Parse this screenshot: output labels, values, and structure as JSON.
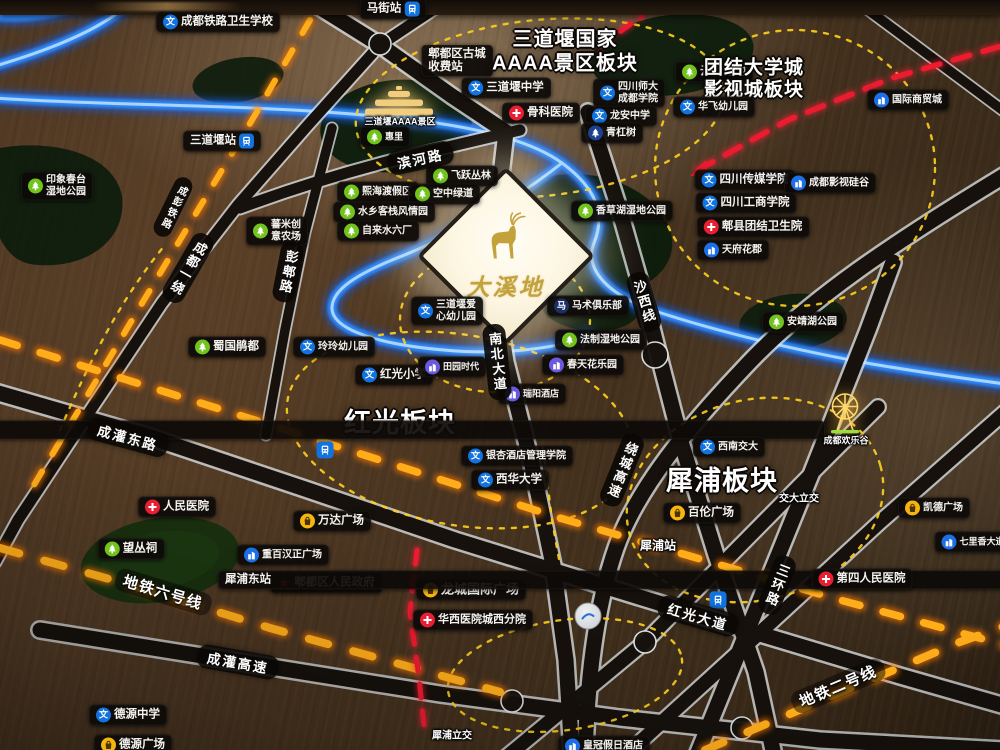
{
  "scene": {
    "description": "Illuminated sales-office district map model, Pidu District Chengdu",
    "project_sign": "大溪地"
  },
  "map": {
    "sign": {
      "text": "大溪地",
      "logo": "deer"
    },
    "palette": {
      "wood": "#47331f",
      "road_dark": "#15100c",
      "road_edge": "#e9edf0",
      "river_glow": "#2f8dff",
      "rail_amber": "#ff9d0e",
      "boundary_yellow": "#ffd21c",
      "route_red": "#ed1b2f",
      "pill_bg": "#0d0a07",
      "icon_school": "#1273e0",
      "icon_hospital": "#e81f33",
      "icon_park": "#72c41d",
      "icon_estate": "#1d6fe8",
      "icon_estate_purple": "#6a5ae0",
      "icon_shop": "#f6b40e",
      "icon_navy": "#1b2f66",
      "sign_gold": "#c3a13b"
    },
    "labels": [
      {
        "t": "成都铁路卫生学校",
        "x": 218,
        "y": 22,
        "k": "pill",
        "ic": "school"
      },
      {
        "t": "马街站",
        "x": 393,
        "y": 9,
        "k": "station"
      },
      {
        "lines": [
          "郫都区古城",
          "收费站"
        ],
        "x": 457,
        "y": 61,
        "k": "pill"
      },
      {
        "lines": [
          "三道堰国家",
          "AAAA景区板块"
        ],
        "x": 565,
        "y": 52,
        "k": "plate",
        "s": 20
      },
      {
        "t": "云桥湿地",
        "x": 714,
        "y": 72,
        "k": "pill",
        "ic": "park"
      },
      {
        "lines": [
          "团结大学城",
          "影视城板块"
        ],
        "x": 754,
        "y": 80,
        "k": "plate",
        "s": 19
      },
      {
        "t": "国际商贸城",
        "x": 908,
        "y": 100,
        "k": "pill",
        "ic": "estate",
        "s": 10
      },
      {
        "t": "三道堰中学",
        "x": 506,
        "y": 88,
        "k": "pill",
        "ic": "school"
      },
      {
        "lines": [
          "四川师大",
          "成都学院"
        ],
        "x": 629,
        "y": 93,
        "k": "pill",
        "ic": "school",
        "s": 10
      },
      {
        "t": "龙安中学",
        "x": 621,
        "y": 116,
        "k": "pill",
        "ic": "school",
        "s": 10
      },
      {
        "t": "骨科医院",
        "x": 541,
        "y": 113,
        "k": "pill",
        "ic": "hosp"
      },
      {
        "t": "华飞幼儿园",
        "x": 714,
        "y": 107,
        "k": "pill",
        "ic": "school",
        "s": 10
      },
      {
        "t": "三道堰站",
        "x": 222,
        "y": 141,
        "k": "station"
      },
      {
        "t": "青杠树",
        "x": 612,
        "y": 133,
        "k": "pill",
        "ic": "treeb",
        "s": 10
      },
      {
        "t": "三道堰AAAA景区",
        "x": 400,
        "y": 121,
        "k": "roadtext",
        "s": 9
      },
      {
        "t": "惠里",
        "x": 385,
        "y": 137,
        "k": "pill",
        "ic": "park",
        "s": 9
      },
      {
        "lines": [
          "印象春台",
          "湿地公园"
        ],
        "x": 57,
        "y": 186,
        "k": "pill",
        "ic": "park",
        "s": 10
      },
      {
        "t": "熙海渡假区",
        "x": 378,
        "y": 192,
        "k": "pill",
        "ic": "park",
        "s": 10
      },
      {
        "t": "飞跃丛林",
        "x": 462,
        "y": 176,
        "k": "pill",
        "ic": "park",
        "s": 10
      },
      {
        "t": "空中绿道",
        "x": 444,
        "y": 194,
        "k": "pill",
        "ic": "park",
        "s": 10
      },
      {
        "t": "水乡客栈风情园",
        "x": 384,
        "y": 212,
        "k": "pill",
        "ic": "park",
        "s": 10
      },
      {
        "t": "自来水六厂",
        "x": 378,
        "y": 231,
        "k": "pill",
        "ic": "park",
        "s": 10
      },
      {
        "lines": [
          "蕃米创",
          "意农场"
        ],
        "x": 277,
        "y": 231,
        "k": "pill",
        "ic": "park",
        "s": 10
      },
      {
        "t": "香草湖湿地公园",
        "x": 622,
        "y": 211,
        "k": "pill",
        "ic": "park",
        "s": 10
      },
      {
        "t": "四川传媒学院",
        "x": 745,
        "y": 180,
        "k": "pill",
        "ic": "school"
      },
      {
        "t": "成都影视硅谷",
        "x": 830,
        "y": 183,
        "k": "pill",
        "ic": "estate",
        "s": 10
      },
      {
        "t": "四川工商学院",
        "x": 746,
        "y": 203,
        "k": "pill",
        "ic": "school"
      },
      {
        "t": "郫县团结卫生院",
        "x": 753,
        "y": 227,
        "k": "pill",
        "ic": "hosp"
      },
      {
        "t": "天府花郡",
        "x": 733,
        "y": 250,
        "k": "pill",
        "ic": "estate",
        "s": 10
      },
      {
        "lines": [
          "三道堰爱",
          "心幼儿园"
        ],
        "x": 447,
        "y": 311,
        "k": "pill",
        "ic": "school",
        "s": 10
      },
      {
        "t": "马术俱乐部",
        "x": 588,
        "y": 306,
        "k": "pill",
        "ic": "horse",
        "s": 10
      },
      {
        "t": "安靖湖公园",
        "x": 803,
        "y": 322,
        "k": "pill",
        "ic": "park",
        "s": 10
      },
      {
        "t": "蜀国鹃都",
        "x": 227,
        "y": 347,
        "k": "pill",
        "ic": "park"
      },
      {
        "t": "玲玲幼儿园",
        "x": 334,
        "y": 347,
        "k": "pill",
        "ic": "school",
        "s": 10
      },
      {
        "t": "法制湿地公园",
        "x": 601,
        "y": 340,
        "k": "pill",
        "ic": "park",
        "s": 10
      },
      {
        "t": "红光小学",
        "x": 394,
        "y": 375,
        "k": "pill",
        "ic": "school"
      },
      {
        "t": "田园时代",
        "x": 452,
        "y": 367,
        "k": "pill",
        "ic": "estate2",
        "s": 9
      },
      {
        "t": "春天花乐园",
        "x": 583,
        "y": 365,
        "k": "pill",
        "ic": "estate2",
        "s": 10
      },
      {
        "t": "瑞阳酒店",
        "x": 532,
        "y": 394,
        "k": "pill",
        "ic": "estate2",
        "s": 9
      },
      {
        "t": "红光板块",
        "x": 400,
        "y": 424,
        "k": "plate",
        "s": 27
      },
      {
        "t": "郫县站",
        "x": 325,
        "y": 430,
        "k": "stationv"
      },
      {
        "t": "银杏酒店管理学院",
        "x": 517,
        "y": 456,
        "k": "pill",
        "ic": "school",
        "s": 10
      },
      {
        "t": "西华大学",
        "x": 510,
        "y": 480,
        "k": "pill",
        "ic": "school"
      },
      {
        "t": "西南交大",
        "x": 729,
        "y": 447,
        "k": "pill",
        "ic": "school",
        "s": 10
      },
      {
        "t": "犀浦板块",
        "x": 722,
        "y": 482,
        "k": "plate",
        "s": 27
      },
      {
        "t": "成都欢乐谷",
        "x": 846,
        "y": 440,
        "k": "roadtext",
        "s": 9
      },
      {
        "t": "百伦广场",
        "x": 702,
        "y": 513,
        "k": "pill",
        "ic": "shop"
      },
      {
        "t": "交大立交",
        "x": 799,
        "y": 497,
        "k": "roadtext",
        "s": 10
      },
      {
        "t": "人民医院",
        "x": 177,
        "y": 507,
        "k": "pill",
        "ic": "hosp"
      },
      {
        "t": "望丛祠",
        "x": 131,
        "y": 549,
        "k": "pill",
        "ic": "park"
      },
      {
        "t": "万达广场",
        "x": 332,
        "y": 521,
        "k": "pill",
        "ic": "shop"
      },
      {
        "t": "重百汉正广场",
        "x": 283,
        "y": 555,
        "k": "pill",
        "ic": "estate",
        "s": 10
      },
      {
        "t": "郫都区人民政府",
        "x": 326,
        "y": 583,
        "k": "pill",
        "ic": "star"
      },
      {
        "t": "龙城国际广场",
        "x": 471,
        "y": 590,
        "k": "pill",
        "ic": "shop",
        "s": 13
      },
      {
        "t": "华西医院城西分院",
        "x": 473,
        "y": 620,
        "k": "pill",
        "ic": "hosp",
        "s": 11
      },
      {
        "t": "犀浦站",
        "x": 658,
        "y": 545,
        "k": "roadtext",
        "s": 12
      },
      {
        "t": "犀浦东站",
        "x": 718,
        "y": 561,
        "k": "stationv"
      },
      {
        "t": "第四人民医院",
        "x": 862,
        "y": 579,
        "k": "pill",
        "ic": "hosp"
      },
      {
        "t": "七里香大道",
        "x": 973,
        "y": 542,
        "k": "pill",
        "ic": "estate",
        "s": 9
      },
      {
        "t": "凯德广场",
        "x": 934,
        "y": 508,
        "k": "pill",
        "ic": "shop",
        "s": 10
      },
      {
        "t": "德源中学",
        "x": 128,
        "y": 715,
        "k": "pill",
        "ic": "school"
      },
      {
        "t": "德源广场",
        "x": 133,
        "y": 745,
        "k": "pill",
        "ic": "shop"
      },
      {
        "t": "皇冠假日酒店",
        "x": 604,
        "y": 746,
        "k": "pill",
        "ic": "estate",
        "s": 10
      },
      {
        "t": "滨河路",
        "x": 420,
        "y": 158,
        "k": "road",
        "r": -12
      },
      {
        "t": "成彭铁路",
        "x": 173,
        "y": 207,
        "k": "roadv",
        "r": 26,
        "s": 10
      },
      {
        "t": "成都一绕",
        "x": 188,
        "y": 268,
        "k": "roadv",
        "r": 30,
        "s": 13
      },
      {
        "t": "彭郫路",
        "x": 288,
        "y": 272,
        "k": "roadv",
        "r": 11,
        "s": 13
      },
      {
        "t": "南北大道",
        "x": 497,
        "y": 362,
        "k": "roadv",
        "r": -6,
        "s": 13
      },
      {
        "t": "沙西线",
        "x": 644,
        "y": 302,
        "k": "roadv",
        "r": -16,
        "s": 13
      },
      {
        "t": "绕城高速",
        "x": 622,
        "y": 470,
        "k": "roadv",
        "r": 22,
        "s": 13
      },
      {
        "t": "三环路",
        "x": 777,
        "y": 585,
        "k": "roadv",
        "r": 21,
        "s": 13
      },
      {
        "t": "成灌东路",
        "x": 128,
        "y": 437,
        "k": "road",
        "r": 15
      },
      {
        "t": "红光大道",
        "x": 698,
        "y": 616,
        "k": "road",
        "r": 16
      },
      {
        "t": "成灌高速",
        "x": 238,
        "y": 662,
        "k": "road",
        "r": 10
      },
      {
        "t": "地铁六号线",
        "x": 163,
        "y": 592,
        "k": "mline",
        "r": 17
      },
      {
        "t": "地铁二号线",
        "x": 838,
        "y": 686,
        "k": "mline",
        "r": -23
      },
      {
        "t": "犀浦立交",
        "x": 452,
        "y": 734,
        "k": "roadtext",
        "s": 10
      }
    ]
  }
}
